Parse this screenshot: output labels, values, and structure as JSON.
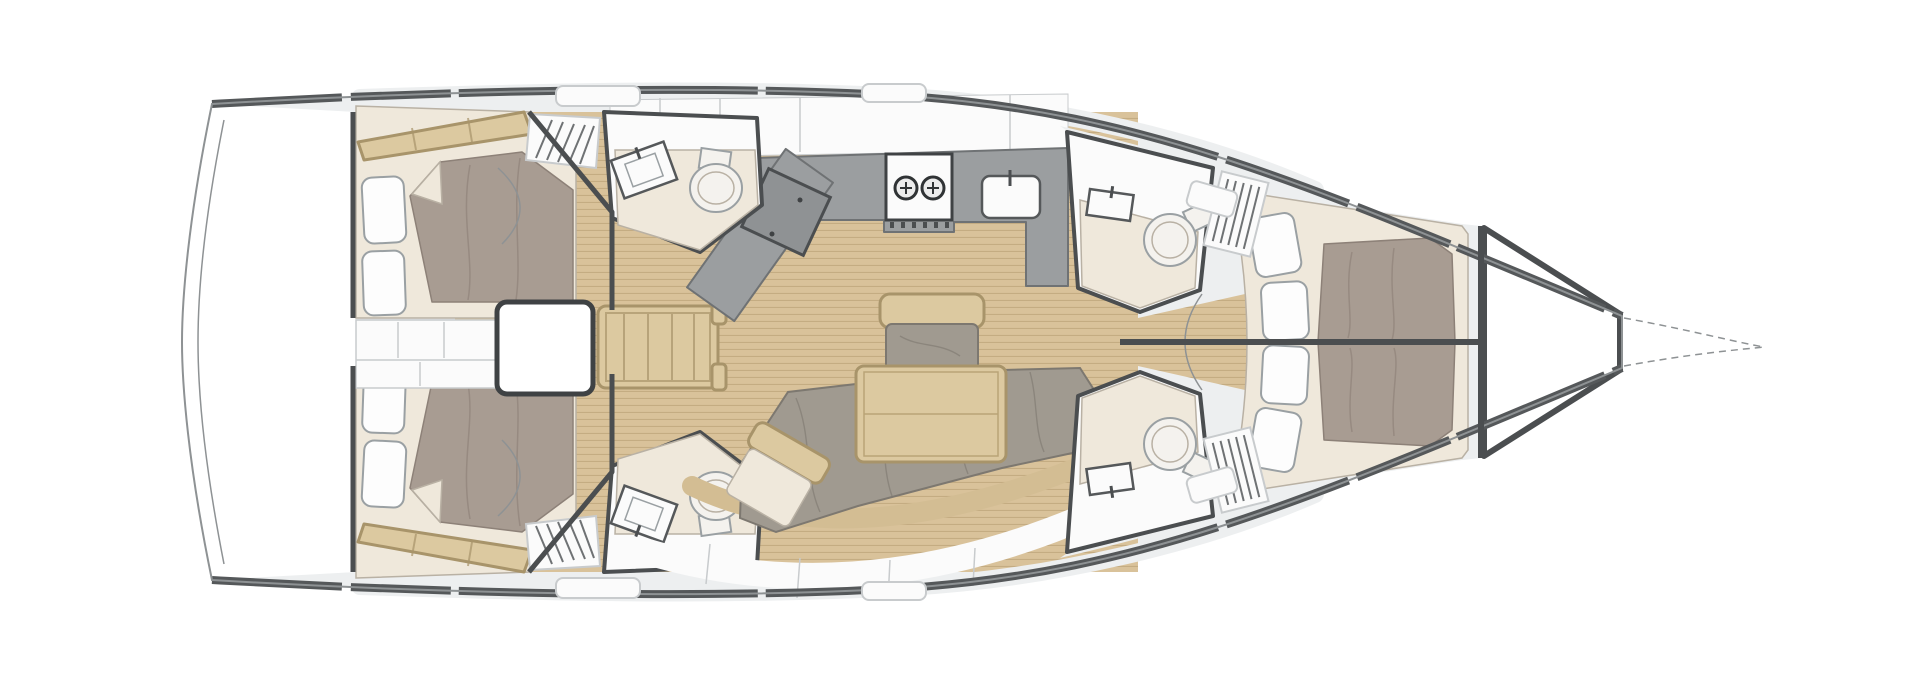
{
  "colors": {
    "page_bg": "#ffffff",
    "hull_outline": "#8e9294",
    "deck_band": "#55585a",
    "wall": "#4b4e50",
    "deck_gray": "#edeff0",
    "room_white": "#fbfbfb",
    "porcelain": "#f4f2ee",
    "wood": "#d9c29a",
    "wood_line": "#c4ac82",
    "wood_furniture": "#dcc9a0",
    "wood_dark": "#a8946a",
    "beige": "#efe8db",
    "beige_line": "#b9b1a4",
    "duvet": "#a89c92",
    "duvet_line": "#8d8178",
    "cushion_gray": "#a09a90",
    "cushion_line": "#7d7870",
    "counter": "#9b9ea0",
    "counter_line": "#6f7274",
    "fixture_line": "#55585a",
    "pillow": "#fdfdfd",
    "pillow_line": "#9aa0a3",
    "seam": "#c8cbcd",
    "tan_shelf": "#d3bd93",
    "burner": "#303335",
    "white": "#ffffff"
  },
  "floor_plan": {
    "type": "sailing-yacht-interior-layout",
    "orientation": "bow-right",
    "rooms": [
      {
        "name": "transom-platform",
        "fixtures": []
      },
      {
        "name": "aft-cabin-port",
        "fixtures": [
          "double-bed",
          "pillow",
          "pillow",
          "louvered-locker",
          "shelf"
        ]
      },
      {
        "name": "aft-cabin-starboard",
        "fixtures": [
          "double-bed",
          "pillow",
          "pillow",
          "louvered-locker",
          "shelf"
        ]
      },
      {
        "name": "engine-compartment",
        "fixtures": []
      },
      {
        "name": "companionway-steps",
        "fixtures": [
          "ladder-treads"
        ]
      },
      {
        "name": "aft-head-port",
        "fixtures": [
          "sink",
          "toilet",
          "shower-floor"
        ]
      },
      {
        "name": "aft-head-starboard",
        "fixtures": [
          "sink",
          "toilet",
          "shower-floor"
        ]
      },
      {
        "name": "galley",
        "fixtures": [
          "two-burner-stove",
          "sink",
          "counter",
          "fridge-block"
        ]
      },
      {
        "name": "nav-station",
        "fixtures": [
          "chart-table",
          "angled-counter"
        ]
      },
      {
        "name": "salon",
        "fixtures": [
          "dining-table",
          "l-shaped-sofa",
          "bench-seat",
          "side-seat",
          "plank-floor"
        ]
      },
      {
        "name": "forward-head-port",
        "fixtures": [
          "sink",
          "toilet",
          "shower-floor",
          "louvered-locker"
        ]
      },
      {
        "name": "forward-head-starboard",
        "fixtures": [
          "sink",
          "toilet",
          "shower-floor",
          "louvered-locker"
        ]
      },
      {
        "name": "forward-cabin",
        "fixtures": [
          "island-double-bed",
          "pillow",
          "pillow",
          "pillow",
          "pillow",
          "center-seam"
        ]
      },
      {
        "name": "anchor-locker",
        "fixtures": []
      }
    ]
  }
}
